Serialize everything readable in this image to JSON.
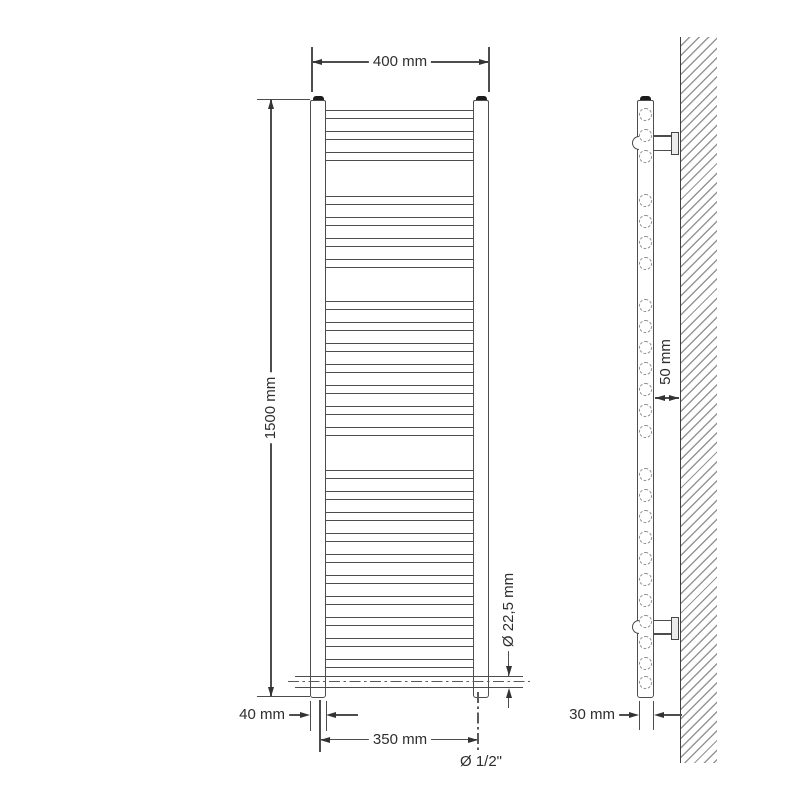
{
  "front_view": {
    "dim_width": "400 mm",
    "dim_height": "1500 mm",
    "dim_collector_width": "40 mm",
    "dim_connection_spacing": "350 mm",
    "dim_tube_diameter": "Ø 22,5 mm",
    "dim_connection_thread": "Ø 1/2\""
  },
  "side_view": {
    "dim_wall_clearance": "50 mm",
    "dim_tube_depth": "30 mm"
  },
  "drawing": {
    "line_color": "#4d4d4d",
    "hatch_color": "#969696",
    "cap_color": "#1c1c1c",
    "rung_groups": [
      {
        "y": 110,
        "count": 3
      },
      {
        "y": 196,
        "count": 4
      },
      {
        "y": 301,
        "count": 7
      },
      {
        "y": 470,
        "count": 10
      }
    ],
    "rung_pitch": 21,
    "rung_height": 9,
    "cross_tube_y": 676,
    "side_circle_extra_y": 682
  }
}
